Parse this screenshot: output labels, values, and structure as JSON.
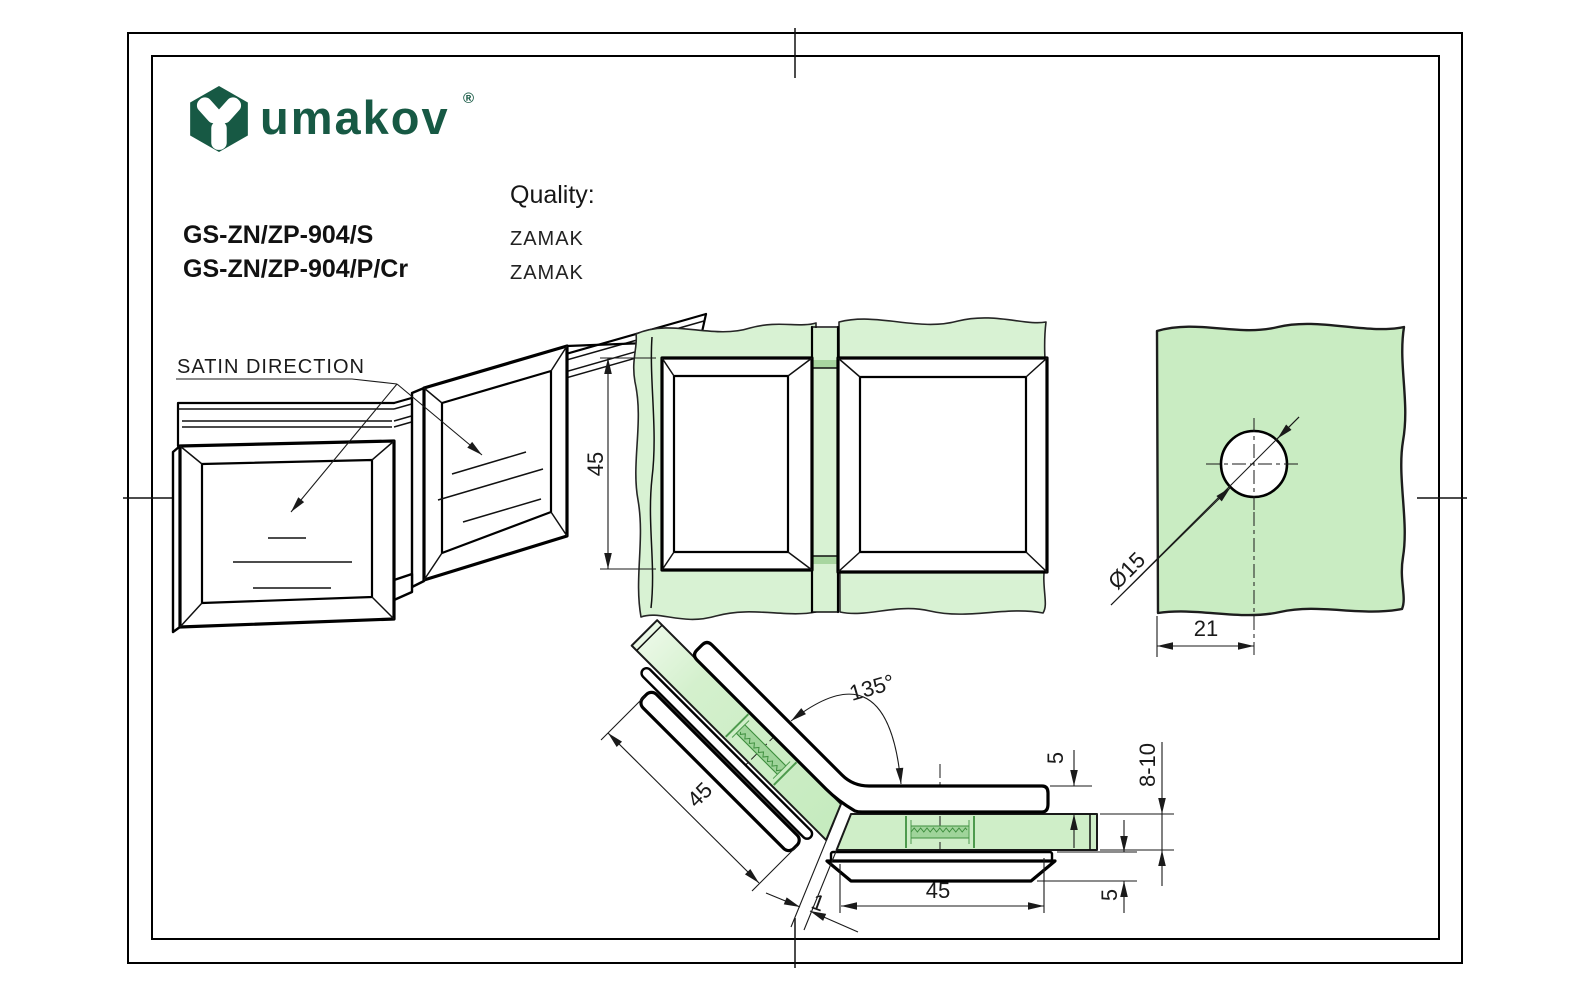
{
  "colors": {
    "brand_green": "#175944",
    "glass_light": "#d8f2d3",
    "glass_mid": "#c9ecc2",
    "glass_soft": "#cfeec8",
    "glass_serr": "#9fd49a",
    "glass_serr_line": "#4e9b4e",
    "line_dark": "#1a1a1a"
  },
  "header": {
    "brand": "umakov",
    "registered_mark": "®",
    "quality_label": "Quality:",
    "products": [
      {
        "code": "GS-ZN/ZP-904/S",
        "quality": "ZAMAK"
      },
      {
        "code": "GS-ZN/ZP-904/P/Cr",
        "quality": "ZAMAK"
      }
    ]
  },
  "annotations": {
    "satin_direction_label": "SATIN DIRECTION"
  },
  "dimensions": {
    "front_height": "45",
    "hole_diameter": "Ø15",
    "hole_offset": "21",
    "angle": "135°",
    "arm_length": "45",
    "base_length": "45",
    "plate_top_thickness": "5",
    "glass_thickness_range": "8-10",
    "plate_bottom_thickness": "5",
    "pane_gap": "1"
  }
}
